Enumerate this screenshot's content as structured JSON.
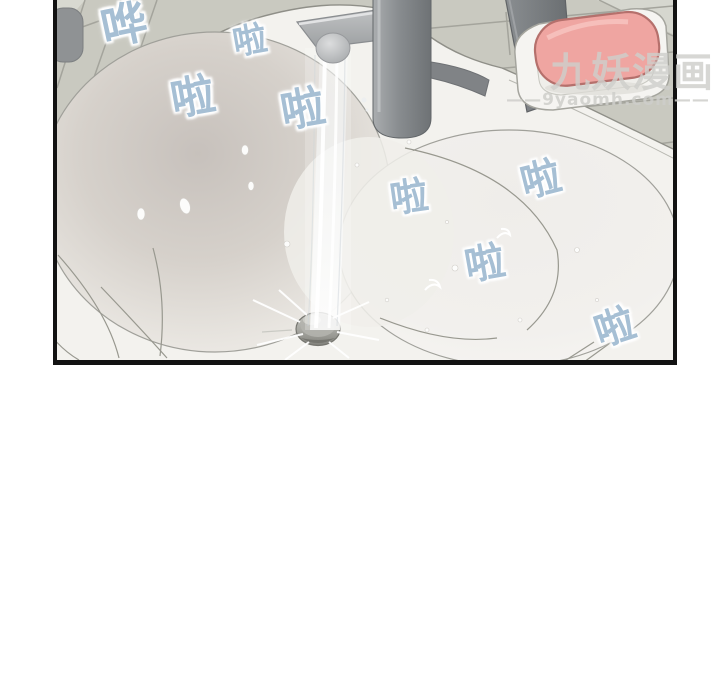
{
  "scene": {
    "description": "Webtoon panel of water running from a faucet into a bathroom sink",
    "panel_border_color": "#121212",
    "page_background": "#ffffff"
  },
  "sfx": {
    "color": "#a6bfd4",
    "items": [
      {
        "name": "sfx-hua",
        "text": "哗"
      },
      {
        "name": "sfx-la-1",
        "text": "啦"
      },
      {
        "name": "sfx-la-2",
        "text": "啦"
      },
      {
        "name": "sfx-la-3",
        "text": "啦"
      },
      {
        "name": "sfx-la-4",
        "text": "啦"
      },
      {
        "name": "sfx-la-5",
        "text": "啦"
      },
      {
        "name": "sfx-la-6",
        "text": "啦"
      },
      {
        "name": "sfx-la-7",
        "text": "啦"
      }
    ]
  },
  "watermark": {
    "title": "九妖漫画",
    "url": "——9yaomh.com——"
  },
  "colors": {
    "tile_wall": "#c9c9c0",
    "tile_grout": "#a4a49c",
    "counter_white": "#f3f2ee",
    "bowl_shadow": "#c7c1bc",
    "faucet_body": "#84888b",
    "faucet_handle": "#75787b",
    "water_highlight": "#ffffff",
    "soap": "#efa5a1",
    "soap_outline": "#b5706c",
    "soap_dish": "#f5f4f1",
    "drain": "#9a9a94"
  }
}
